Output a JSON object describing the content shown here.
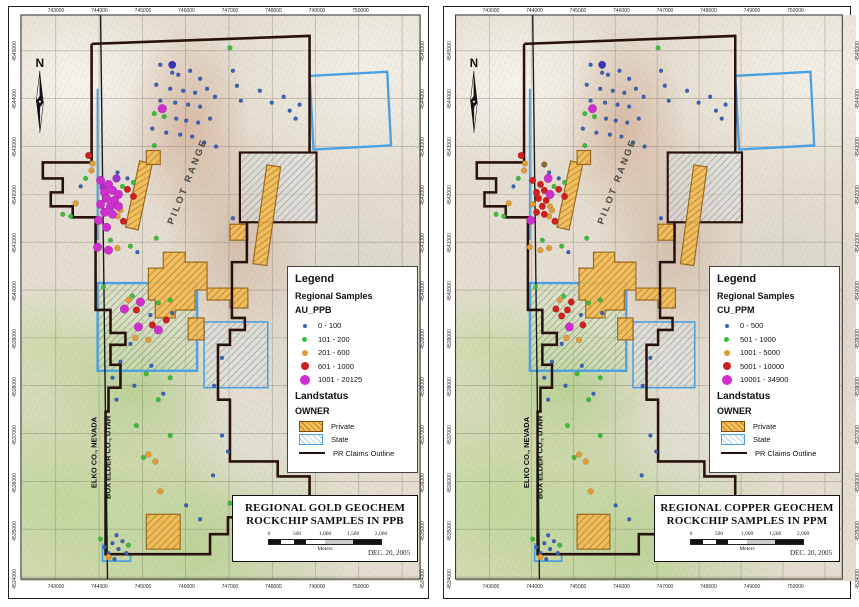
{
  "page": {
    "background": "#ffffff"
  },
  "shared": {
    "edge_eastings": [
      "743000",
      "744000",
      "745000",
      "746000",
      "747000",
      "748000",
      "749000",
      "750000"
    ],
    "edge_northings": [
      "4545000",
      "4544000",
      "4543000",
      "4542000",
      "4541000",
      "4540000",
      "4539000",
      "4538000",
      "4537000",
      "4536000",
      "4535000",
      "4534000"
    ]
  },
  "panels": [
    {
      "id": "gold",
      "north_label": "N",
      "map_title_lines": [
        "REGIONAL GOLD GEOCHEM",
        "ROCKCHIP SAMPLES IN PPB"
      ],
      "date": "DEC. 20, 2005",
      "scalebar": {
        "ticks": [
          "0",
          "500",
          "1,000",
          "1,500",
          "2,000"
        ],
        "unit": "Meters"
      },
      "labels": {
        "range": "PILOT RANGE",
        "county_left": "ELKO CO., NEVADA",
        "county_right": "BOX ELDER CO., UTAH"
      },
      "legend": {
        "title": "Legend",
        "section": "Regional Samples",
        "field": "AU_PPB",
        "classes": [
          {
            "label": "0 - 100",
            "color": "#3a62b8",
            "size": 4
          },
          {
            "label": "101 - 200",
            "color": "#3dbb3d",
            "size": 5
          },
          {
            "label": "201 - 600",
            "color": "#e09c3a",
            "size": 6
          },
          {
            "label": "601 - 1000",
            "color": "#cc1f1f",
            "size": 8
          },
          {
            "label": "1001 - 20125",
            "color": "#ce2fce",
            "size": 10
          }
        ],
        "landstatus_title": "Landstatus",
        "owner_title": "OWNER",
        "owner_classes": [
          {
            "label": "Private",
            "type": "private"
          },
          {
            "label": "State",
            "type": "state"
          },
          {
            "label": "PR Claims Outline",
            "type": "claims"
          }
        ]
      },
      "dots_key": "dots_gold"
    },
    {
      "id": "copper",
      "north_label": "N",
      "map_title_lines": [
        "REGIONAL COPPER GEOCHEM",
        "ROCKCHIP SAMPLES IN PPM"
      ],
      "date": "DEC. 20, 2005",
      "scalebar": {
        "ticks": [
          "0",
          "500",
          "1,000",
          "1,500",
          "2,000"
        ],
        "unit": "Meters"
      },
      "labels": {
        "range": "PILOT RANGE",
        "county_left": "ELKO CO., NEVADA",
        "county_right": "BOX ELDER CO., UTAH"
      },
      "legend": {
        "title": "Legend",
        "section": "Regional Samples",
        "field": "CU_PPM",
        "classes": [
          {
            "label": "0 - 500",
            "color": "#3a62b8",
            "size": 4
          },
          {
            "label": "501 - 1000",
            "color": "#3dbb3d",
            "size": 5
          },
          {
            "label": "1001 - 5000",
            "color": "#e09c3a",
            "size": 6
          },
          {
            "label": "5001 - 10000",
            "color": "#cc1f1f",
            "size": 8
          },
          {
            "label": "10001 - 34900",
            "color": "#ce2fce",
            "size": 10
          }
        ],
        "landstatus_title": "Landstatus",
        "owner_title": "OWNER",
        "owner_classes": [
          {
            "label": "Private",
            "type": "private"
          },
          {
            "label": "State",
            "type": "state"
          },
          {
            "label": "PR Claims Outline",
            "type": "claims"
          }
        ]
      },
      "dots_key": "dots_copper"
    }
  ],
  "map_geometry": {
    "grid_x": [
      47,
      90.5,
      134,
      177.5,
      221,
      264.5,
      308,
      351.5,
      395
    ],
    "grid_y": [
      44,
      92,
      140,
      188,
      236,
      284,
      332,
      380,
      428,
      476,
      524,
      572
    ],
    "claims_color": "#2a120c",
    "state_color": "#4da0e0",
    "claims_paths": [
      "M83,37 L302,29 L302,146",
      "M83,37 L83,156 L34,156 L34,172 L54,172 L54,186 L42,186 L42,200 L64,200 L64,211 L87,211 L87,304 L102,304 L102,327 L117,327 L117,339 L102,339 L102,359 L112,359 L112,382 L100,382 L100,406 L97,406 L97,549 L202,549 L202,529 L220,529 L220,512 L232,512 L232,494 L302,494 L302,471 L270,471 L270,456 L222,456 L222,394 L210,394 L210,339 L222,339 L222,324 L237,324 L237,312 L224,312 L224,256 L239,256 L239,216"
    ],
    "county_path": "M92,8 L99,576",
    "state_features": [
      {
        "t": "line",
        "x1": 89,
        "y1": 82,
        "x2": 89,
        "y2": 234,
        "w": 2
      },
      {
        "t": "rect",
        "x": 304,
        "y": 67,
        "w": 78,
        "h": 74,
        "f": "none",
        "sw": 2.4,
        "rot": -3
      },
      {
        "t": "rect",
        "x": 232,
        "y": 146,
        "w": 77,
        "h": 70,
        "f": "gray",
        "sc": "claims",
        "sw": 2.2
      },
      {
        "t": "rect",
        "x": 89,
        "y": 277,
        "w": 100,
        "h": 88,
        "f": "green",
        "sw": 2.4
      },
      {
        "t": "rect",
        "x": 196,
        "y": 316,
        "w": 64,
        "h": 66,
        "f": "gray",
        "sw": 1.6
      },
      {
        "t": "polyline",
        "pts": "94,538 94,556 122,556 122,548",
        "w": 1.8
      }
    ],
    "private_polys": [
      {
        "t": "rect",
        "x": 124,
        "y": 155,
        "w": 13,
        "h": 68,
        "rot": 12
      },
      {
        "t": "rect",
        "x": 252,
        "y": 159,
        "w": 14,
        "h": 100,
        "rot": 8
      },
      {
        "t": "rect",
        "x": 138,
        "y": 144,
        "w": 14,
        "h": 14
      },
      {
        "t": "poly",
        "pts": "155,246 177,246 177,256 199,256 199,284 187,284 187,304 167,304 167,312 147,312 147,294 140,294 140,262 155,262"
      },
      {
        "t": "poly",
        "pts": "199,282 240,282 240,302 222,302 222,294 199,294"
      },
      {
        "t": "rect",
        "x": 180,
        "y": 312,
        "w": 16,
        "h": 22
      },
      {
        "t": "rect",
        "x": 222,
        "y": 218,
        "w": 18,
        "h": 16
      },
      {
        "t": "rect",
        "x": 138,
        "y": 509,
        "w": 34,
        "h": 35
      }
    ],
    "label_anchors": {
      "range": {
        "x": 182,
        "y": 176,
        "rot": -68
      },
      "county_left": {
        "x": 88,
        "y": 447,
        "rot": -90
      },
      "county_right": {
        "x": 102,
        "y": 452,
        "rot": -90
      }
    },
    "dot_styles": {
      "blue2": {
        "c": "#3a62b8",
        "r": 2
      },
      "navy4": {
        "c": "#3b35b5",
        "r": 3.8
      },
      "green2_5": {
        "c": "#3dbb3d",
        "r": 2.4
      },
      "orange3": {
        "c": "#e09c3a",
        "r": 3
      },
      "red3_5": {
        "c": "#cf1f1f",
        "r": 3.4
      },
      "purple4": {
        "c": "#9a35cf",
        "r": 4
      },
      "magenta4_5": {
        "c": "#ce2fce",
        "r": 4.4
      },
      "brown3": {
        "c": "#8a6a3a",
        "r": 3
      }
    },
    "dots_common": {
      "blue2": [
        [
          152,
          58
        ],
        [
          164,
          66
        ],
        [
          170,
          68
        ],
        [
          182,
          64
        ],
        [
          192,
          72
        ],
        [
          148,
          78
        ],
        [
          162,
          82
        ],
        [
          175,
          84
        ],
        [
          187,
          86
        ],
        [
          199,
          82
        ],
        [
          207,
          90
        ],
        [
          152,
          94
        ],
        [
          167,
          96
        ],
        [
          180,
          98
        ],
        [
          192,
          100
        ],
        [
          168,
          112
        ],
        [
          178,
          114
        ],
        [
          190,
          116
        ],
        [
          202,
          112
        ],
        [
          144,
          122
        ],
        [
          158,
          126
        ],
        [
          172,
          128
        ],
        [
          184,
          130
        ],
        [
          196,
          136
        ],
        [
          208,
          140
        ],
        [
          225,
          64
        ],
        [
          229,
          79
        ],
        [
          233,
          94
        ],
        [
          252,
          84
        ],
        [
          264,
          96
        ],
        [
          276,
          90
        ],
        [
          282,
          104
        ],
        [
          292,
          98
        ],
        [
          288,
          112
        ],
        [
          225,
          212
        ],
        [
          109,
          166
        ],
        [
          119,
          172
        ],
        [
          72,
          180
        ],
        [
          129,
          246
        ],
        [
          142,
          309
        ],
        [
          164,
          307
        ],
        [
          122,
          338
        ],
        [
          112,
          356
        ],
        [
          104,
          372
        ],
        [
          126,
          380
        ],
        [
          108,
          394
        ],
        [
          178,
          500
        ],
        [
          192,
          514
        ],
        [
          205,
          470
        ],
        [
          108,
          530
        ],
        [
          114,
          536
        ],
        [
          104,
          538
        ],
        [
          110,
          544
        ],
        [
          118,
          548
        ],
        [
          100,
          548
        ],
        [
          106,
          554
        ],
        [
          96,
          542
        ],
        [
          214,
          430
        ],
        [
          220,
          446
        ],
        [
          206,
          380
        ],
        [
          214,
          352
        ],
        [
          232,
          524
        ],
        [
          155,
          388
        ],
        [
          143,
          360
        ]
      ],
      "navy4": [
        [
          164,
          58
        ]
      ],
      "green2_5": [
        [
          146,
          107
        ],
        [
          156,
          110
        ],
        [
          146,
          139
        ],
        [
          222,
          41
        ],
        [
          77,
          172
        ],
        [
          114,
          180
        ],
        [
          125,
          176
        ],
        [
          54,
          208
        ],
        [
          62,
          210
        ],
        [
          102,
          234
        ],
        [
          122,
          240
        ],
        [
          95,
          281
        ],
        [
          124,
          290
        ],
        [
          150,
          297
        ],
        [
          162,
          294
        ],
        [
          138,
          368
        ],
        [
          162,
          372
        ],
        [
          150,
          394
        ],
        [
          128,
          420
        ],
        [
          162,
          430
        ],
        [
          222,
          498
        ],
        [
          92,
          534
        ],
        [
          120,
          540
        ],
        [
          230,
          512
        ],
        [
          148,
          232
        ],
        [
          135,
          452
        ]
      ],
      "orange3": [
        [
          140,
          449
        ],
        [
          147,
          456
        ],
        [
          100,
          552
        ],
        [
          152,
          486
        ]
      ]
    },
    "dots_gold": {
      "orange3": [
        [
          84,
          157
        ],
        [
          83,
          164
        ],
        [
          112,
          204
        ],
        [
          109,
          210
        ],
        [
          67,
          197
        ],
        [
          109,
          242
        ],
        [
          120,
          294
        ],
        [
          127,
          332
        ],
        [
          140,
          334
        ]
      ],
      "red3_5": [
        [
          80,
          149
        ],
        [
          119,
          183
        ],
        [
          125,
          190
        ],
        [
          115,
          215
        ],
        [
          128,
          304
        ],
        [
          144,
          319
        ],
        [
          158,
          314
        ]
      ],
      "purple4": [
        [
          108,
          172
        ],
        [
          95,
          181
        ]
      ],
      "magenta4_5": [
        [
          154,
          102
        ],
        [
          92,
          174
        ],
        [
          100,
          178
        ],
        [
          96,
          186
        ],
        [
          104,
          184
        ],
        [
          110,
          188
        ],
        [
          98,
          192
        ],
        [
          106,
          194
        ],
        [
          92,
          198
        ],
        [
          102,
          200
        ],
        [
          110,
          200
        ],
        [
          96,
          206
        ],
        [
          104,
          208
        ],
        [
          90,
          214
        ],
        [
          98,
          221
        ],
        [
          89,
          241
        ],
        [
          100,
          244
        ],
        [
          132,
          296
        ],
        [
          116,
          303
        ],
        [
          130,
          321
        ],
        [
          150,
          324
        ]
      ]
    },
    "dots_copper": {
      "brown3": [
        [
          104,
          158
        ]
      ],
      "orange3": [
        [
          84,
          157
        ],
        [
          83,
          164
        ],
        [
          92,
          198
        ],
        [
          110,
          200
        ],
        [
          112,
          204
        ],
        [
          109,
          210
        ],
        [
          67,
          197
        ],
        [
          89,
          241
        ],
        [
          109,
          242
        ],
        [
          100,
          244
        ],
        [
          120,
          294
        ],
        [
          127,
          332
        ],
        [
          140,
          334
        ]
      ],
      "red3_5": [
        [
          80,
          149
        ],
        [
          92,
          174
        ],
        [
          100,
          178
        ],
        [
          96,
          186
        ],
        [
          104,
          184
        ],
        [
          98,
          192
        ],
        [
          106,
          194
        ],
        [
          102,
          200
        ],
        [
          96,
          206
        ],
        [
          104,
          208
        ],
        [
          115,
          215
        ],
        [
          119,
          183
        ],
        [
          125,
          190
        ],
        [
          132,
          296
        ],
        [
          128,
          304
        ],
        [
          116,
          303
        ],
        [
          122,
          310
        ],
        [
          144,
          319
        ]
      ],
      "magenta4_5": [
        [
          154,
          102
        ],
        [
          110,
          188
        ],
        [
          90,
          214
        ],
        [
          108,
          172
        ],
        [
          130,
          321
        ]
      ]
    }
  }
}
